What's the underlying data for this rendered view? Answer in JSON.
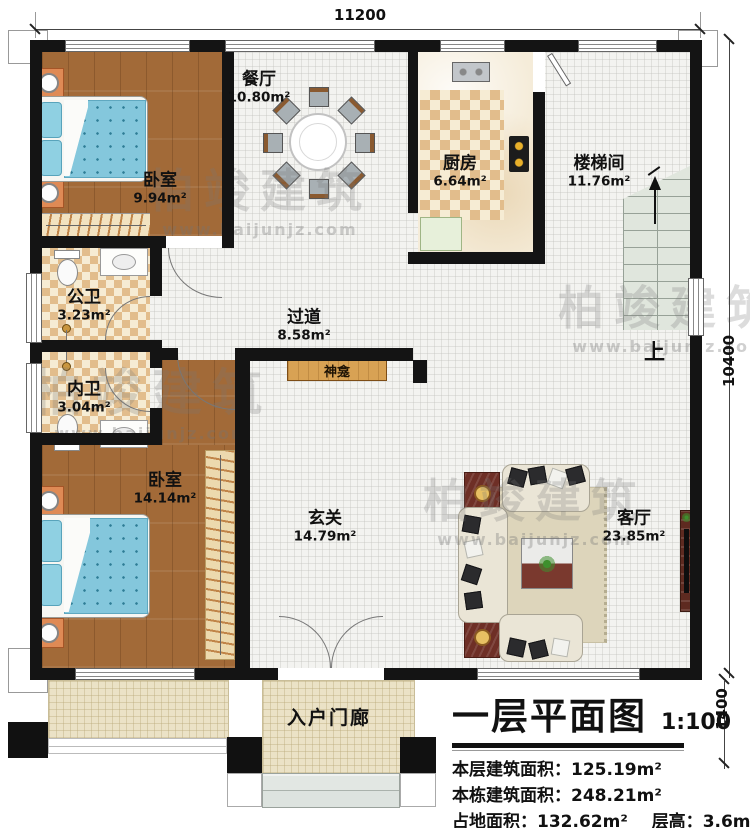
{
  "title": {
    "main": "一层平面图",
    "scale": "1:100"
  },
  "dims": {
    "top": "11200",
    "right": "10400",
    "porch": "1400"
  },
  "rooms": [
    {
      "name": "卧室",
      "area": "9.94m²"
    },
    {
      "name": "餐厅",
      "area": "10.80m²"
    },
    {
      "name": "厨房",
      "area": "6.64m²"
    },
    {
      "name": "楼梯间",
      "area": "11.76m²"
    },
    {
      "name": "公卫",
      "area": "3.23m²"
    },
    {
      "name": "过道",
      "area": "8.58m²"
    },
    {
      "name": "内卫",
      "area": "3.04m²"
    },
    {
      "name": "卧室",
      "area": "14.14m²"
    },
    {
      "name": "玄关",
      "area": "14.79m²"
    },
    {
      "name": "客厅",
      "area": "23.85m²"
    }
  ],
  "labels": {
    "shrine": "神龛",
    "up": "上",
    "porch": "入户门廊"
  },
  "stats": {
    "rows": [
      {
        "label": "本层建筑面积：",
        "value": "125.19m²"
      },
      {
        "label": "本栋建筑面积：",
        "value": "248.21m²"
      },
      {
        "label": "占地面积：",
        "value": "132.62m²",
        "label2": "层高：",
        "value2": "3.6m"
      }
    ]
  },
  "watermark": {
    "name": "柏竣建筑",
    "url": "www.baijunjz.com"
  },
  "colors": {
    "wall": "#141414",
    "wood": "#a26a38",
    "tile": "#f3f3f0",
    "checker": "#e2bd8c",
    "mattress": "#84c7dc",
    "shrine_wood": "#d8a254"
  }
}
